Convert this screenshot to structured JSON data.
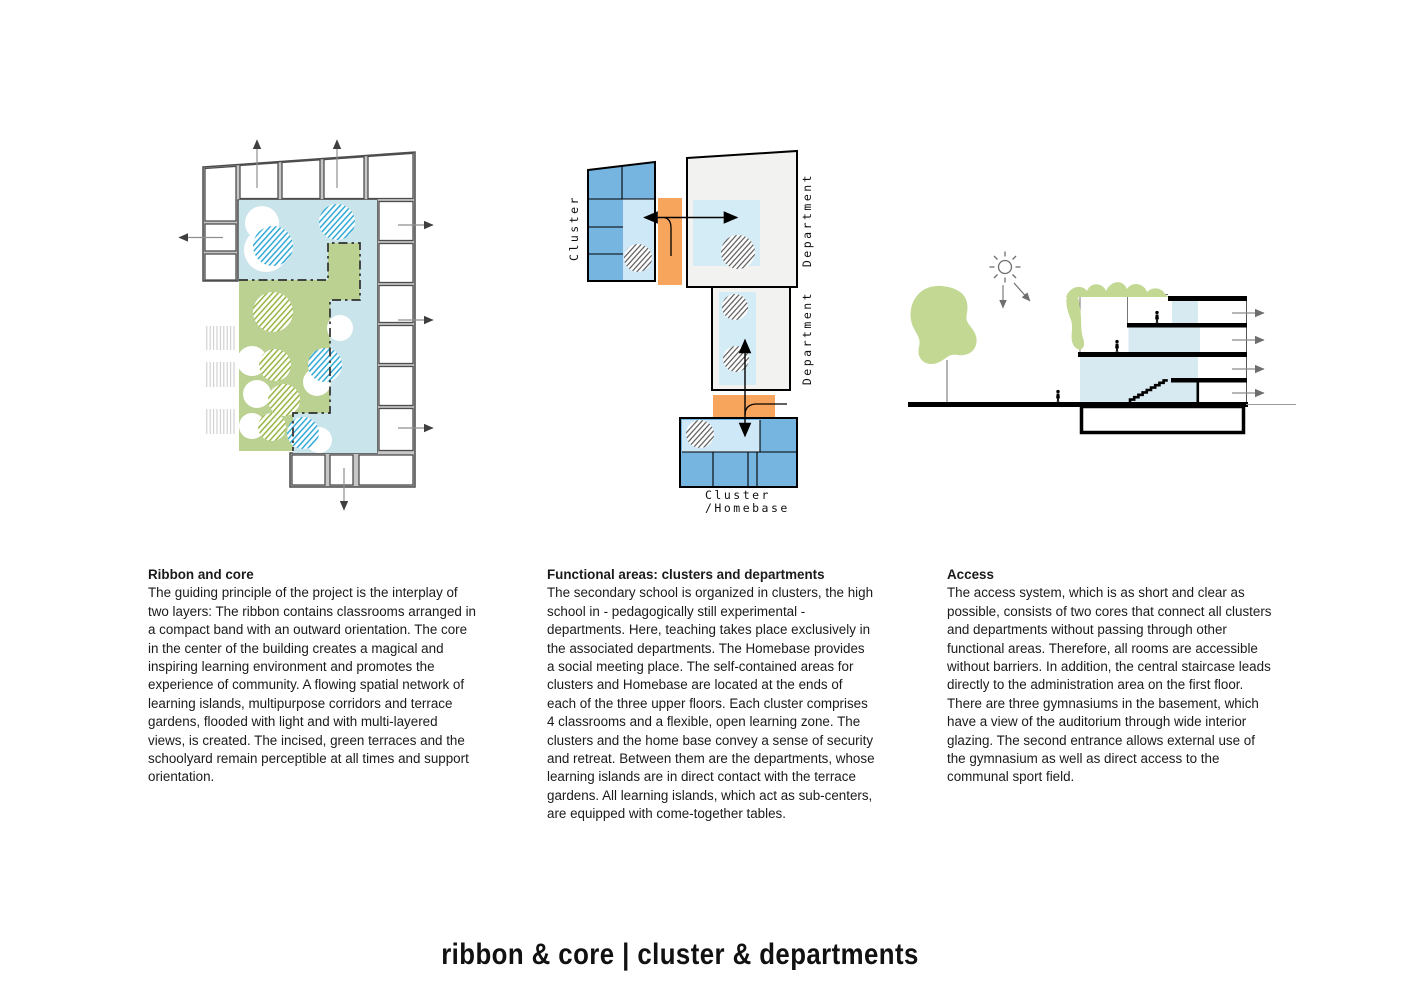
{
  "title": "ribbon & core | cluster & departments",
  "sections": [
    {
      "heading": "Ribbon and core",
      "body": "The guiding principle of the project is the interplay of two layers: The ribbon contains classrooms arranged in a compact band with an outward orientation. The core in the center of the building creates a magical and inspiring learning environment and promotes the experience of community. A flowing spatial network of learning islands, multipurpose corridors and terrace gardens, flooded with light and with multi-layered views, is created. The incised, green terraces and the schoolyard remain perceptible at all times and support orientation."
    },
    {
      "heading": "Functional areas: clusters and departments",
      "body": "The secondary school is organized in clusters, the high school in - pedagogically still experimental - departments. Here, teaching takes place exclusively in the associated departments. The Homebase provides a social meeting place. The self-contained areas for clusters and Homebase are located at the ends of each of the three upper floors. Each cluster comprises 4 classrooms and a flexible, open learning zone. The clusters and the home base convey a sense of security and retreat. Between them are the departments, whose learning islands are in direct contact with the terrace gardens. All learning islands, which act as sub-centers, are equipped with come-together tables."
    },
    {
      "heading": "Access",
      "body": "The access system, which is as short and clear as possible, consists of two cores that connect all clusters and departments without passing through other functional areas. Therefore, all rooms are accessible without barriers. In addition, the central staircase leads directly to the administration area on the first floor. There are three gymnasiums in the basement, which have a view of the auditorium through wide interior glazing. The second entrance allows external use of the gymnasium as well as direct access to the communal sport field."
    }
  ],
  "functional_diagram": {
    "labels": {
      "cluster": "Cluster",
      "department_top": "Department",
      "department_mid": "Department",
      "homebase_line1": "Cluster",
      "homebase_line2": "/Homebase"
    }
  },
  "colors": {
    "plan_core_blue": "#c9e4ea",
    "plan_terrace_green": "#bbd191",
    "plan_hatch_blue": "#2da7d6",
    "plan_hatch_green": "#94b440",
    "ribbon_wall_gray": "#c7c7c7",
    "plan_outline": "#4d4d4d",
    "cluster_blue": "#76b5df",
    "cluster_light_blue": "#cfe8f7",
    "department_gray": "#f2f2f1",
    "department_light_blue": "#d4ecf5",
    "connector_orange": "#f7a55c",
    "section_blue": "#d8eaf1",
    "section_green": "#c3d893",
    "ink": "#1a1a1a"
  }
}
